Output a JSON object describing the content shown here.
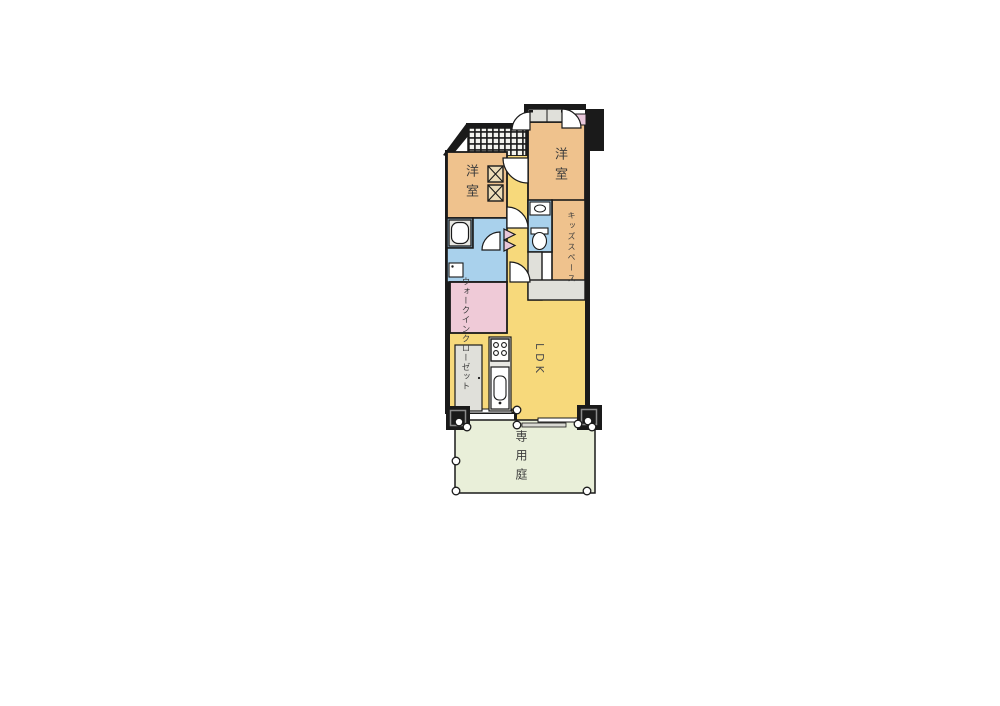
{
  "floorplan": {
    "rooms": {
      "bedroom_left": {
        "label": "洋室"
      },
      "bedroom_right": {
        "label": "洋室"
      },
      "kids_space": {
        "label": "キッズスペース"
      },
      "walk_in_closet": {
        "label": "ウォークインクローゼット"
      },
      "ldk": {
        "label": "LDK"
      },
      "private_garden": {
        "label": "専用庭"
      }
    },
    "colors": {
      "wall": "#1a1a1a",
      "room_tan": "#efc28d",
      "corridor_yellow": "#f7d97b",
      "water_blue": "#a9d1ec",
      "closet_pink": "#efcad7",
      "garden_green": "#e9efd9",
      "fixture_gray": "#e8e8e3",
      "storage_gray": "#e0e0da",
      "door_leaf_white": "#ffffff",
      "meter_pink": "#e9c7da"
    },
    "fixtures": [
      "bathtub",
      "washing-machine",
      "washbasin",
      "toilet",
      "gas-stove",
      "kitchen-sink",
      "refrigerator-space",
      "entrance-closet",
      "meter-box",
      "garden-fence-posts"
    ]
  }
}
